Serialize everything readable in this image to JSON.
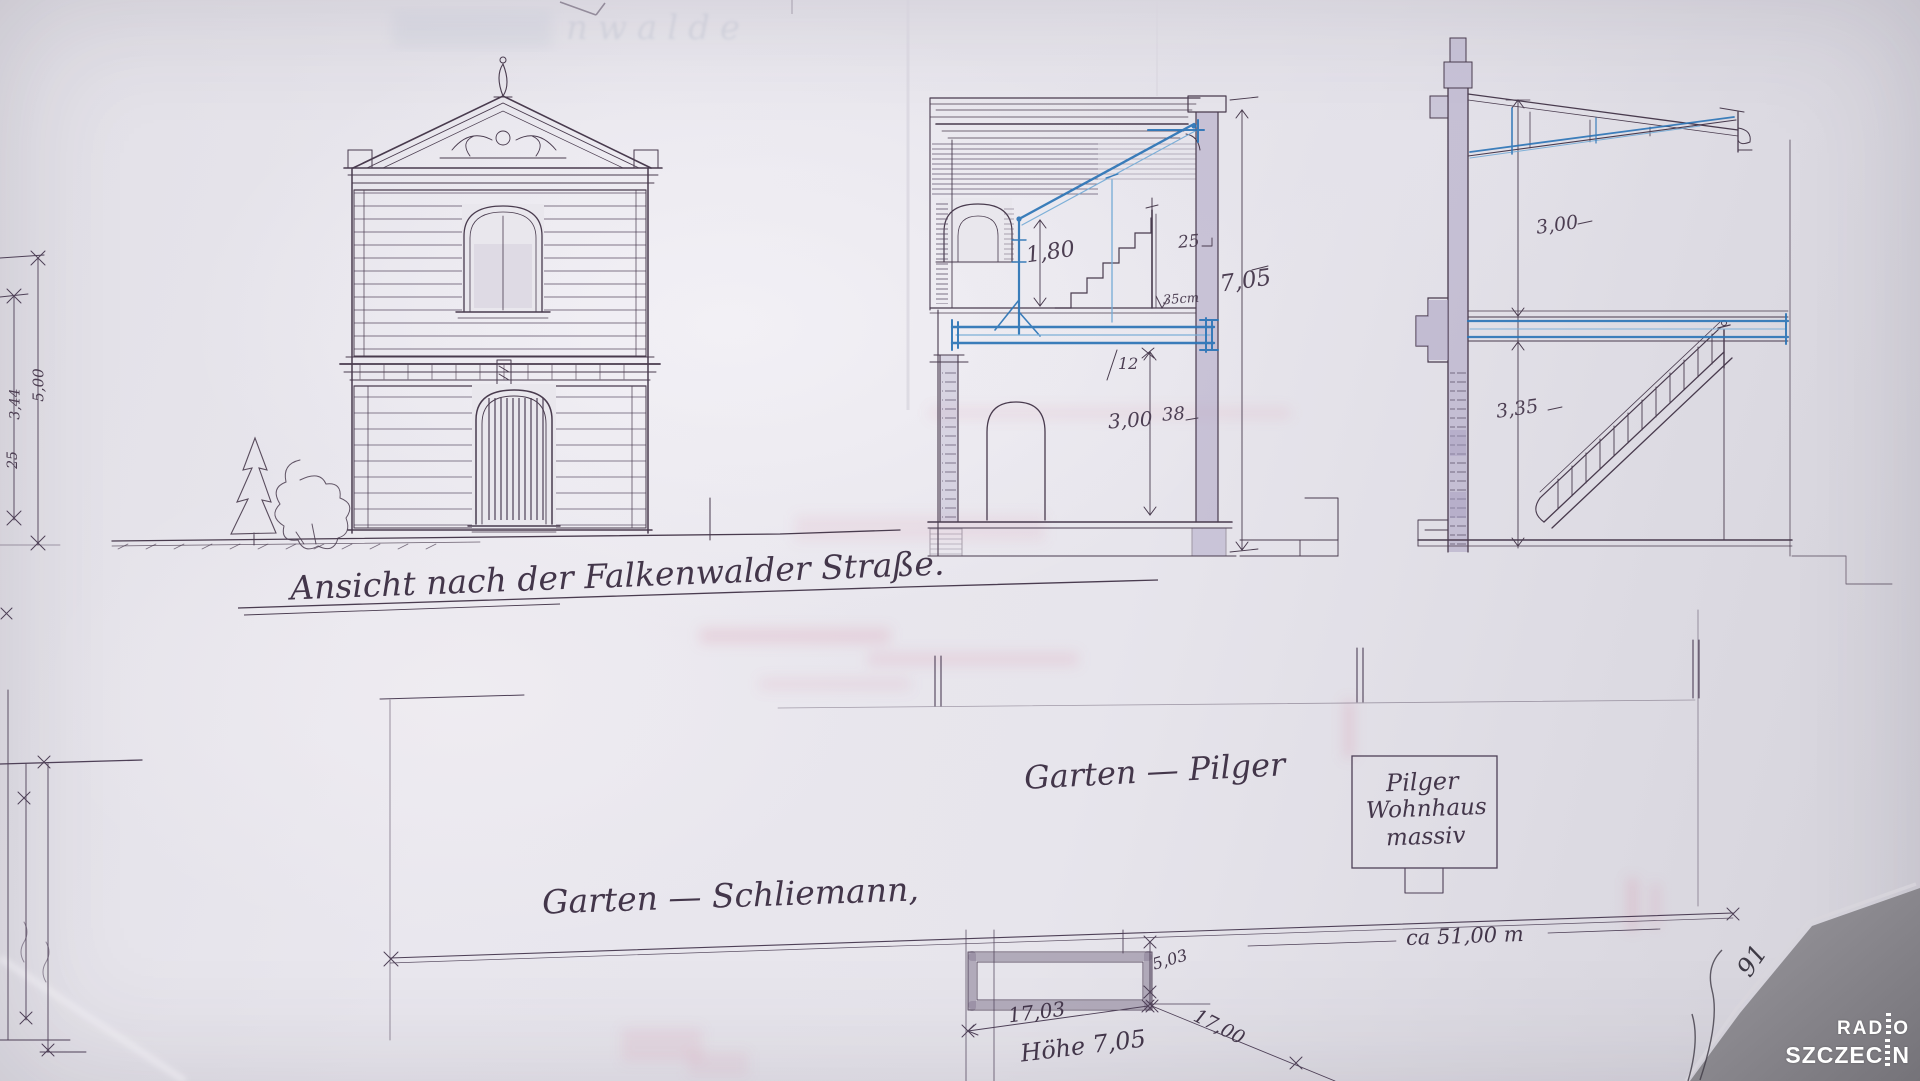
{
  "colors": {
    "paper": "#e8e6ec",
    "ink": "#493b4e",
    "steel_blue": "#2b74b6",
    "steel_blue_light": "#74abd6",
    "wall_poche": "#a79ec0",
    "bleed_pink": "#d98ca6",
    "corner_gray": "#8b898f",
    "logo_white": "#ffffff"
  },
  "elevation": {
    "caption": "Ansicht nach der Falkenwalder Straße."
  },
  "section_mid": {
    "dim_upper_height": "1,80",
    "dim_cornice": "25",
    "dim_total_height": "7,05",
    "dim_slab": "35cm",
    "dim_beam": "12",
    "dim_floor_height": "3,00",
    "dim_wall_thickness": "38"
  },
  "section_right": {
    "dim_upper_height": "3,00",
    "dim_lower_height": "3,35"
  },
  "left_margin": {
    "dim_a": "5,00",
    "dim_b": "3,44",
    "dim_c": "25"
  },
  "site_plan": {
    "garden_pilger": "Garten — Pilger",
    "pilger_house": {
      "line1": "Pilger",
      "line2": "Wohnhaus",
      "line3": "massiv"
    },
    "garden_schliemann": "Garten — Schliemann,",
    "boundary_length": "ca 51,00 m",
    "dim_width": "17,03",
    "dim_height_note": "Höhe 7,05",
    "dim_depth": "5,03",
    "dim_diagonal": "17,00"
  },
  "margin_note": "91",
  "bleed_text": "nwalde",
  "watermark": {
    "line1_pre": "RAD",
    "line1_post": "O",
    "line2_pre": "SZCZEC",
    "line2_post": "N"
  }
}
